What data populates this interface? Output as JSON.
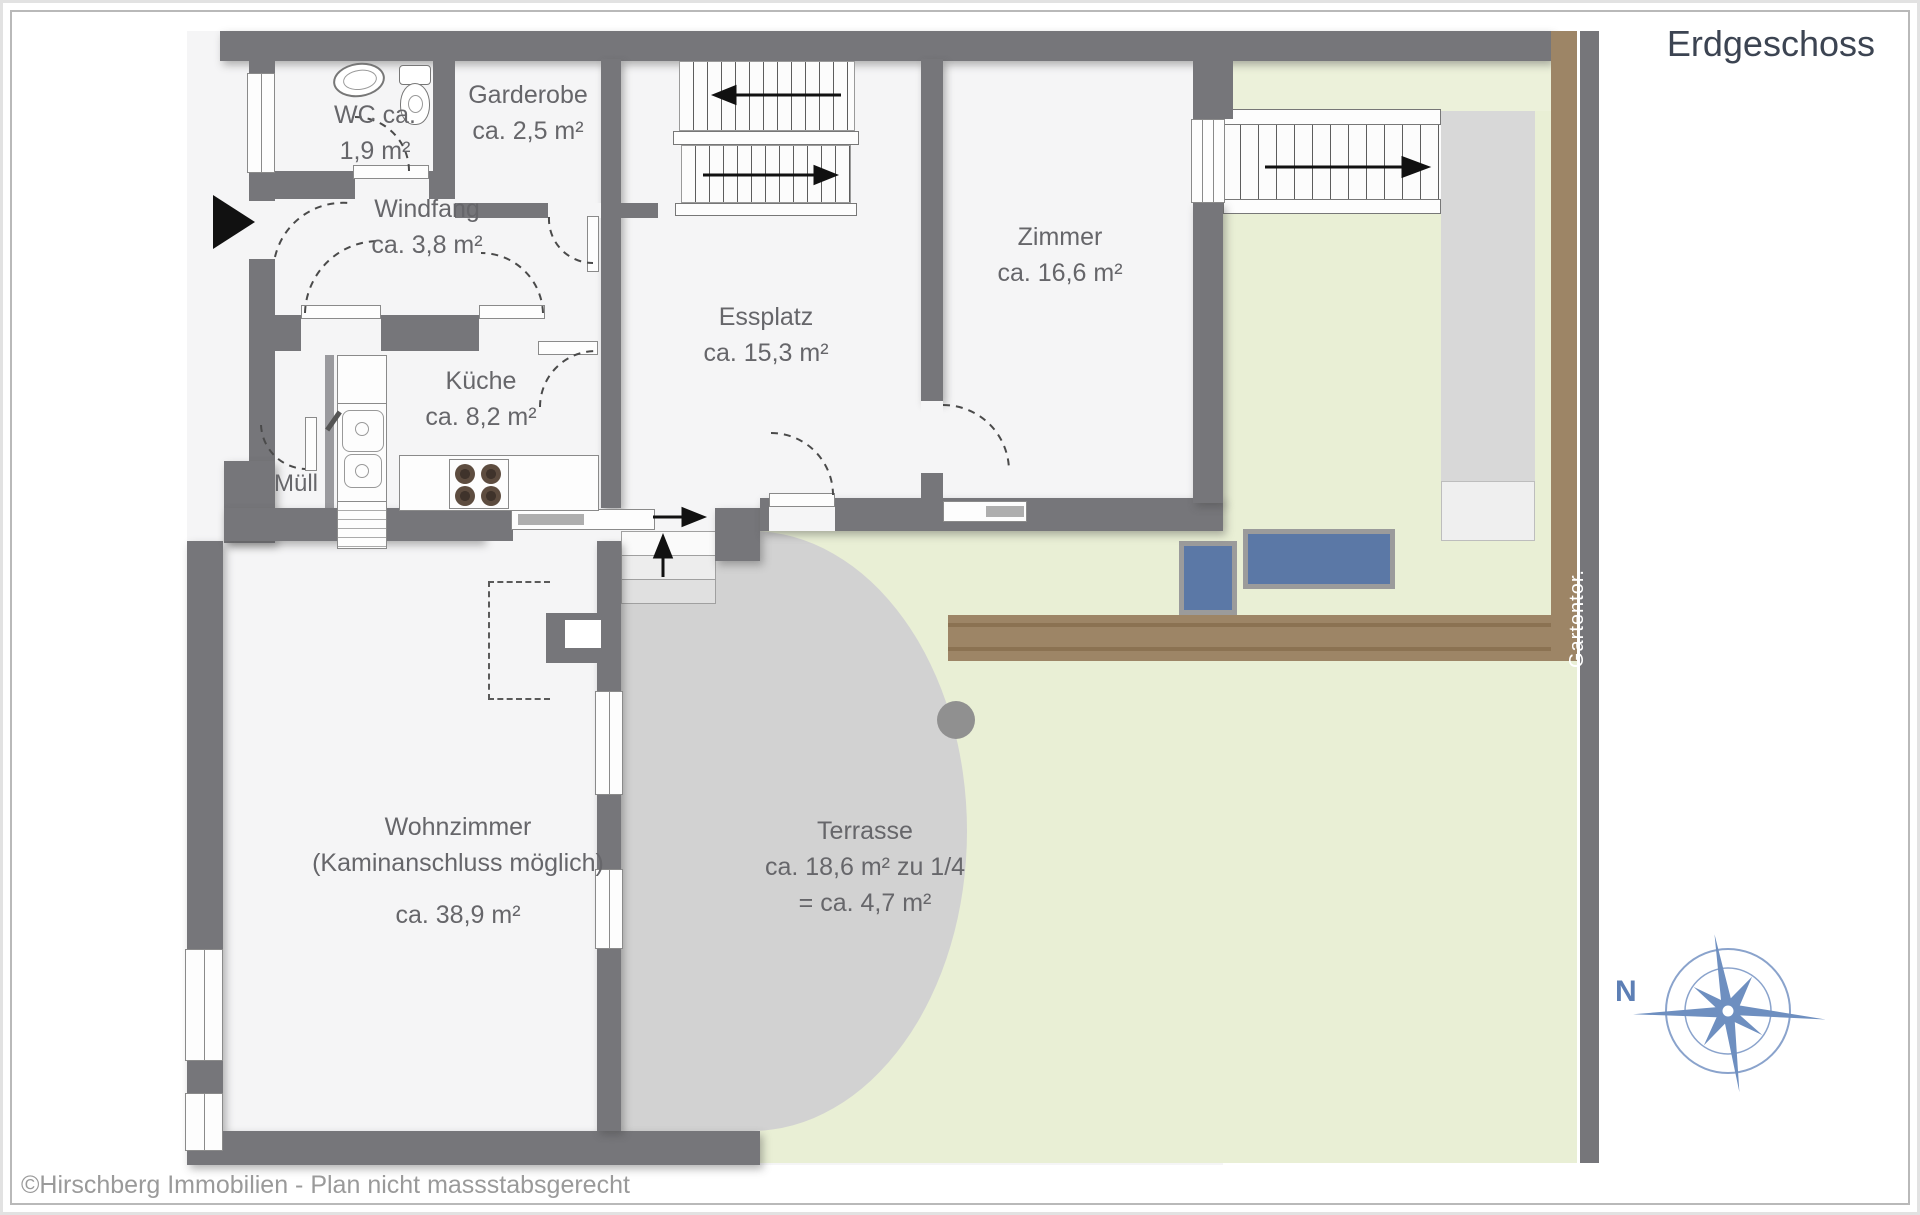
{
  "title": "Erdgeschoss",
  "footer": "©Hirschberg Immobilien - Plan nicht massstabsgerecht",
  "compass": {
    "north_label": "N",
    "color": "#6e8fc0"
  },
  "garden": {
    "gate_label": "Gartentor."
  },
  "rooms": [
    {
      "id": "wc",
      "lines": [
        "WC ca.",
        "1,9 m²"
      ]
    },
    {
      "id": "garderobe",
      "lines": [
        "Garderobe",
        "ca. 2,5 m²"
      ]
    },
    {
      "id": "windfang",
      "lines": [
        "Windfang",
        "ca. 3,8 m²"
      ]
    },
    {
      "id": "essplatz",
      "lines": [
        "Essplatz",
        "ca. 15,3 m²"
      ]
    },
    {
      "id": "kueche",
      "lines": [
        "Küche",
        "ca. 8,2 m²"
      ]
    },
    {
      "id": "zimmer",
      "lines": [
        "Zimmer",
        "ca. 16,6 m²"
      ]
    },
    {
      "id": "wohnzimmer",
      "lines": [
        "Wohnzimmer",
        "(Kaminanschluss möglich)",
        "ca. 38,9 m²"
      ]
    },
    {
      "id": "terrasse",
      "lines": [
        "Terrasse",
        "ca. 18,6 m² zu 1/4",
        "= ca. 4,7 m²"
      ]
    },
    {
      "id": "muell",
      "lines": [
        "Müll"
      ]
    }
  ],
  "colors": {
    "wall": "#76767a",
    "interior": "#f5f5f6",
    "garden_green": "#e9efd5",
    "terrace_gray": "#d2d2d2",
    "path_brown": "#9d8566",
    "furniture_blue": "#5b78a6",
    "label_gray": "#66666a",
    "compass_blue": "#6e8fc0"
  }
}
